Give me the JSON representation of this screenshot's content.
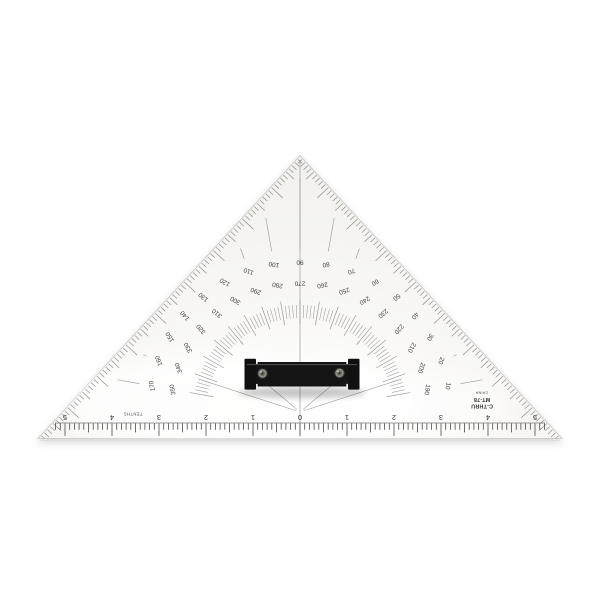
{
  "scene": {
    "description": "Clear acrylic navigation protractor triangle (45-45-90) with black center handle, photographed on a white background"
  },
  "brand": {
    "line1": "C-THRU",
    "line2": "MT-78",
    "line3": "CHINA"
  },
  "protractor": {
    "outer_degree_labels": [
      "10",
      "20",
      "30",
      "40",
      "50",
      "60",
      "70",
      "80",
      "90",
      "100",
      "110",
      "120",
      "130",
      "140",
      "150",
      "160",
      "170"
    ],
    "inner_degree_labels": [
      "190",
      "200",
      "210",
      "220",
      "230",
      "240",
      "250",
      "260",
      "270",
      "280",
      "290",
      "300",
      "310",
      "320",
      "330",
      "340",
      "350"
    ]
  },
  "ruler": {
    "label": "TENTHS",
    "numbers": [
      "5",
      "4",
      "3",
      "2",
      "1",
      "0",
      "1",
      "2",
      "3",
      "4",
      "5"
    ]
  },
  "colors": {
    "body": "#f7f6f3",
    "edge_line": "#cfcecb",
    "tick_line": "#9a9a9a",
    "ruler_tick": "#4a4a4a",
    "label_text": "#3f3f3f",
    "handle": "#141414",
    "screw": "#8f8f86"
  }
}
